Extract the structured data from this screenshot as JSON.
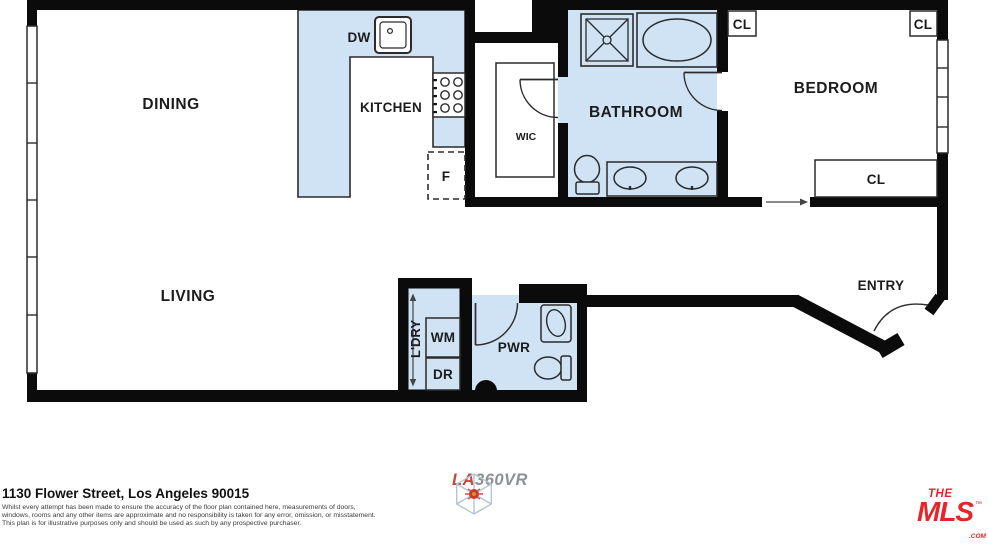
{
  "rooms": {
    "dining": "DINING",
    "kitchen": "KITCHEN",
    "living": "LIVING",
    "wic": "WIC",
    "bathroom": "BATHROOM",
    "bedroom": "BEDROOM",
    "entry": "ENTRY",
    "powder": "PWR",
    "laundry": "L'DRY"
  },
  "appliances": {
    "dishwasher": "DW",
    "fridge": "F",
    "washer": "WM",
    "dryer": "DR"
  },
  "closets": {
    "hall_top": "CL",
    "bedroom_top": "CL",
    "bedroom_wall": "CL"
  },
  "footer": {
    "address": "1130 Flower Street, Los Angeles 90015",
    "disclaimer": [
      "Whilst every attempt has been made to ensure the accuracy of the floor plan contained here, measurements of doors,",
      "windows, rooms and any other items are approximate and no responsibility is taken for any error, omission, or misstatement.",
      "This plan is for illustrative purposes only and should be used as such by any prospective purchaser."
    ]
  },
  "logos": {
    "la360vr": {
      "la": "LA",
      "vr360": "360VR"
    },
    "themls": {
      "the": "THE",
      "mls": "MLS",
      "tm": "™",
      "com": ".COM"
    }
  },
  "colors": {
    "room_fill": "#cfe3f5",
    "wall": "#0b0b0b",
    "mls_red": "#e52528",
    "la360_red": "#c8463c",
    "la360_gray": "#8d9196"
  }
}
